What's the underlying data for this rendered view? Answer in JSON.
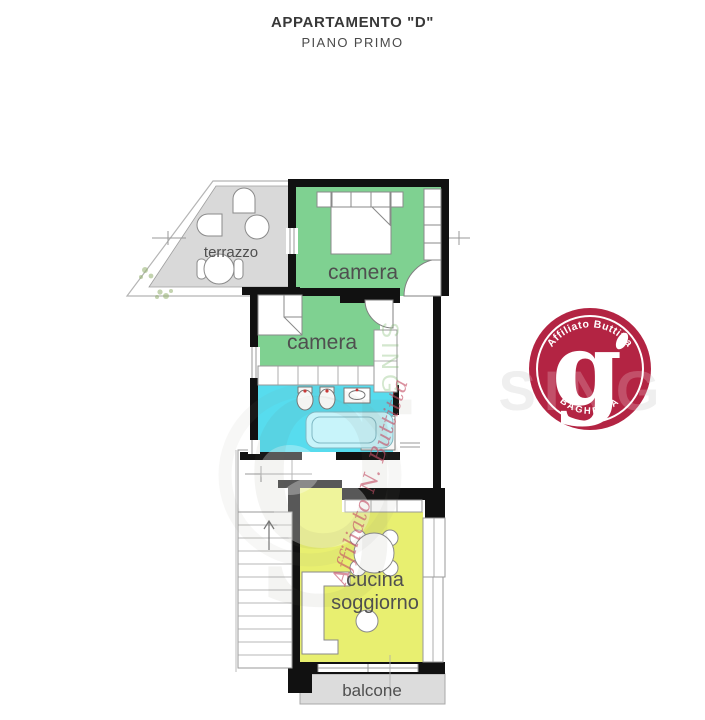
{
  "title": {
    "line1": "APPARTAMENTO \"D\"",
    "line2": "PIANO PRIMO"
  },
  "rooms": {
    "terrazzo": "terrazzo",
    "camera1": "camera",
    "camera2": "camera",
    "cucina1": "cucina",
    "cucina2": "soggiorno",
    "balcone": "balcone"
  },
  "logo": {
    "top": "Affiliato Buttitta",
    "letter": "g",
    "bottom": "BAGHERIA",
    "color": "#b32443"
  },
  "watermarks": {
    "script": "Affiliato N. Buttitta",
    "ghost_letter": "g",
    "logo_overlay": "SING",
    "vertical": "SING"
  },
  "colors": {
    "bedroom_green": "#7fd191",
    "bath_cyan": "#57dcee",
    "kitchen_yellow": "#e8ef70",
    "terrace_gray": "#d9d9d9",
    "balcony_gray": "#dcdcdc",
    "wall_black": "#111111",
    "label_gray": "#4f4f4f",
    "fixture_dot_red": "#cc3333"
  }
}
